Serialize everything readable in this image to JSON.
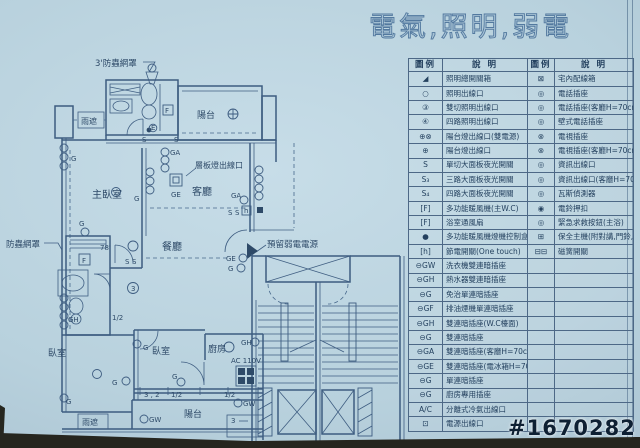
{
  "title": "電氣,照明,弱電",
  "watermark": "#1670282",
  "legend": {
    "headers": [
      "圖例",
      "說 明",
      "圖例",
      "說 明"
    ],
    "rows": [
      [
        "◢",
        "照明總開關箱",
        "⊠",
        "宅內配線箱"
      ],
      [
        "○",
        "照明出線口",
        "◎",
        "電話插座"
      ],
      [
        "③",
        "雙切照明出線口",
        "◎",
        "電話插座(客廳H=70cm)"
      ],
      [
        "④",
        "四路照明出線口",
        "◎",
        "壁式電話插座"
      ],
      [
        "⊕⊗",
        "陽台燈出線口(雙電源)",
        "⊗",
        "電視插座"
      ],
      [
        "⊕",
        "陽台燈出線口",
        "⊗",
        "電視插座(客廳H=70cm)"
      ],
      [
        "S",
        "單切大面板夜光開關",
        "◎",
        "資訊出線口"
      ],
      [
        "S₃",
        "三路大面板夜光開關",
        "◎",
        "資訊出線口(客廳H=70cm)"
      ],
      [
        "S₄",
        "四路大面板夜光開關",
        "◎",
        "瓦斯偵測器"
      ],
      [
        "[F]",
        "多功能暖風機(主W.C)",
        "◉",
        "電鈴押扣"
      ],
      [
        "[F]",
        "浴室通風扇",
        "◎",
        "緊急求救按鈕(主浴)"
      ],
      [
        "●",
        "多功能暖風機燈機控制盒",
        "⊞",
        "保全主機(附對講,門鈴,緊急求救)"
      ],
      [
        "[h]",
        "節電開關(One touch)",
        "⊟⊟",
        "磁簧開關"
      ],
      [
        "⊖GW",
        "洗衣機雙連暗插座",
        "",
        ""
      ],
      [
        "⊖GH",
        "熱水器雙連暗插座",
        "",
        ""
      ],
      [
        "⊖G",
        "免治單連暗插座",
        "",
        ""
      ],
      [
        "⊖GF",
        "排油煙機單連暗插座",
        "",
        ""
      ],
      [
        "⊖GH",
        "雙連暗插座(W.C檯面)",
        "",
        ""
      ],
      [
        "⊖G",
        "雙連暗插座",
        "",
        ""
      ],
      [
        "⊖GA",
        "雙連暗插座(客廳H=70cm)",
        "",
        ""
      ],
      [
        "⊖GE",
        "雙連暗插座(電冰箱H=70cm)",
        "",
        ""
      ],
      [
        "⊖G",
        "單連暗插座",
        "",
        ""
      ],
      [
        "⊖G",
        "廚房專用插座",
        "",
        ""
      ],
      [
        "A/C",
        "分離式冷氣出線口",
        "",
        ""
      ],
      [
        "⊡",
        "電源出線口",
        "",
        ""
      ]
    ]
  },
  "plan": {
    "labels": {
      "balcony_top": "陽台",
      "rain_top": "雨遮",
      "master_bedroom": "主臥室",
      "living": "客廳",
      "dining": "餐廳",
      "bedroom1": "臥室",
      "bedroom2": "臥室",
      "kitchen": "廚房",
      "balcony_bottom": "陽台",
      "rain_bottom": "雨遮"
    },
    "annotations": {
      "screen_top": "3'防蟲網罩",
      "screen_left": "防蟲網罩",
      "shelf_light": "層板燈出線口",
      "reserved_power": "預留弱電電源",
      "ac_voltage": "AC 110V"
    },
    "glyphs": [
      {
        "t": "S",
        "x": 142,
        "y": 142
      },
      {
        "t": "S",
        "x": 174,
        "y": 142
      },
      {
        "t": "E",
        "x": 151,
        "y": 130,
        "s": 5
      },
      {
        "t": "G",
        "x": 71,
        "y": 161
      },
      {
        "t": "GA",
        "x": 170,
        "y": 155,
        "s": 6.5
      },
      {
        "t": "GE",
        "x": 171,
        "y": 197,
        "s": 6.5
      },
      {
        "t": "G",
        "x": 134,
        "y": 201
      },
      {
        "t": "G",
        "x": 79,
        "y": 226
      },
      {
        "t": "GA",
        "x": 231,
        "y": 198,
        "s": 6.5
      },
      {
        "t": "S",
        "x": 228,
        "y": 215
      },
      {
        "t": "S",
        "x": 235,
        "y": 215
      },
      {
        "t": "h",
        "x": 244,
        "y": 213,
        "s": 6
      },
      {
        "t": "78'",
        "x": 100,
        "y": 250,
        "s": 7
      },
      {
        "t": "S",
        "x": 125,
        "y": 264
      },
      {
        "t": "S",
        "x": 132,
        "y": 264
      },
      {
        "t": "3",
        "x": 131,
        "y": 291,
        "s": 6.5
      },
      {
        "t": "F",
        "x": 82,
        "y": 263,
        "s": 7
      },
      {
        "t": "F",
        "x": 165,
        "y": 113,
        "s": 7
      },
      {
        "t": "1/2",
        "x": 112,
        "y": 320,
        "s": 6.5
      },
      {
        "t": "GH",
        "x": 68,
        "y": 322,
        "s": 6.5
      },
      {
        "t": "GE",
        "x": 226,
        "y": 261,
        "s": 6.5
      },
      {
        "t": "G",
        "x": 228,
        "y": 271
      },
      {
        "t": "G",
        "x": 143,
        "y": 350
      },
      {
        "t": "GH",
        "x": 241,
        "y": 345,
        "s": 6.5
      },
      {
        "t": "G",
        "x": 172,
        "y": 379
      },
      {
        "t": "G",
        "x": 112,
        "y": 385
      },
      {
        "t": "G",
        "x": 66,
        "y": 404
      },
      {
        "t": "GW",
        "x": 149,
        "y": 422,
        "s": 6.5
      },
      {
        "t": "GW",
        "x": 243,
        "y": 406,
        "s": 6.5
      },
      {
        "t": "3 , 2",
        "x": 144,
        "y": 397,
        "s": 6.5
      },
      {
        "t": "1/2",
        "x": 171,
        "y": 397,
        "s": 6
      },
      {
        "t": "1/2",
        "x": 224,
        "y": 397,
        "s": 6
      },
      {
        "t": "3",
        "x": 231,
        "y": 423,
        "s": 6.5
      }
    ]
  }
}
